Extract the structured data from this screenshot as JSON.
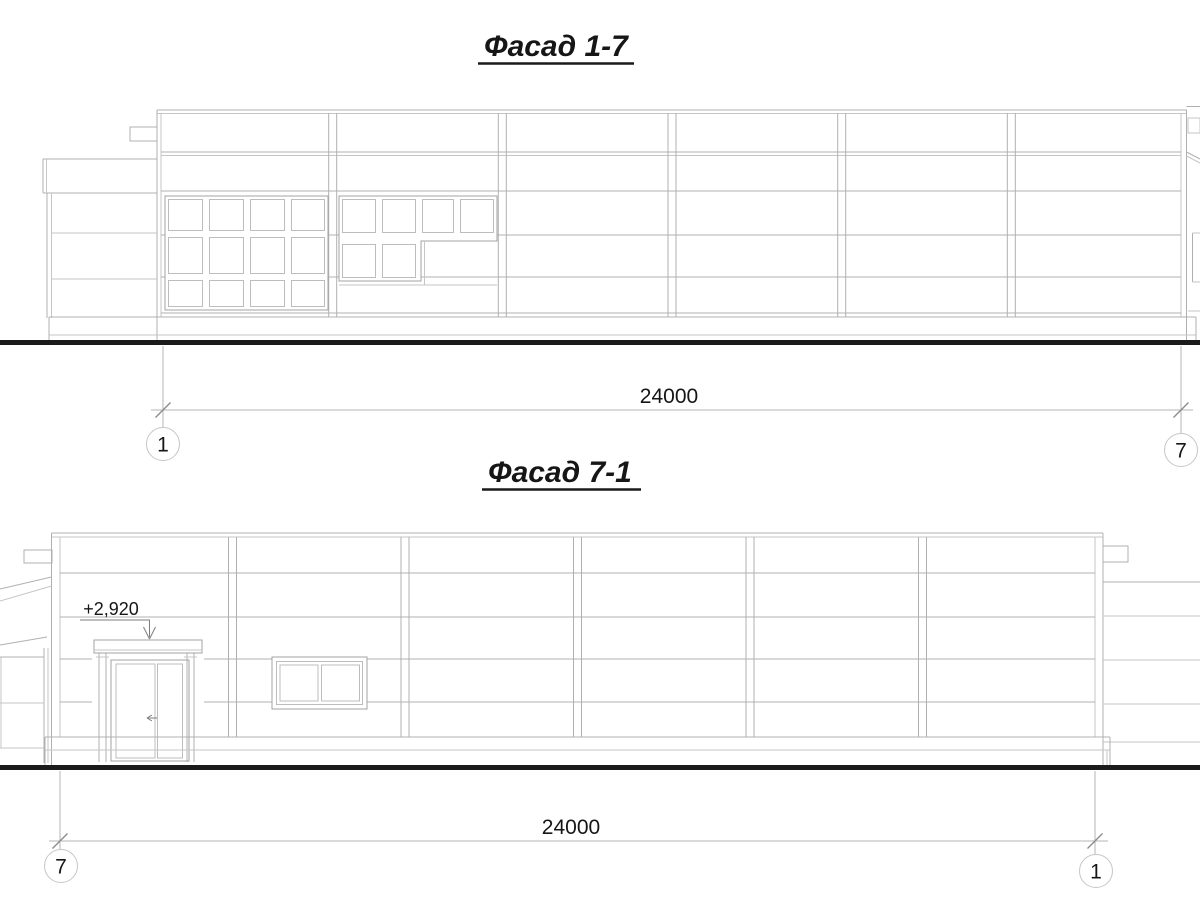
{
  "drawing": {
    "background_color": "#ffffff",
    "line_color": "#b0b0b0",
    "ground_line_color": "#1b1b1b",
    "text_color": "#161616"
  },
  "facade_top": {
    "title": "Фасад 1-7",
    "dimension": "24000",
    "axis_left": "1",
    "axis_right": "7"
  },
  "facade_bottom": {
    "title": "Фасад 7-1",
    "dimension": "24000",
    "axis_left": "7",
    "axis_right": "1",
    "elevation_mark": "+2,920"
  }
}
